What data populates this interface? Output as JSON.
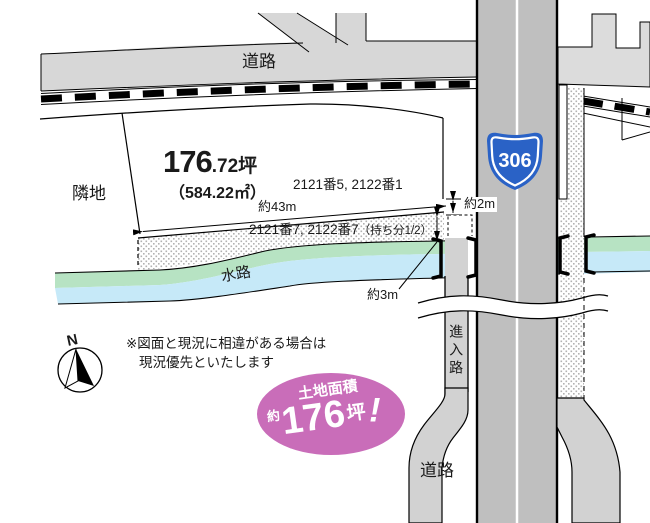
{
  "labels": {
    "road_top": "道路",
    "road_bottom": "道路",
    "neighbor": "隣地",
    "waterway": "水路",
    "approach_road": "進入路",
    "route_number": "306",
    "north": "N"
  },
  "parcel": {
    "area_tsubo_main": "176",
    "area_tsubo_sub": ".72坪",
    "area_m2": "（584.22㎡）",
    "lot_numbers": "2121番5, 2122番1"
  },
  "strip": {
    "lot_numbers": "2121番7, 2122番7",
    "share": "（持ち分1/2）"
  },
  "dimensions": {
    "width": "約43m",
    "gap": "約2m",
    "strip_depth": "約3m"
  },
  "note": {
    "line1": "※図面と現況に相違がある場合は",
    "line2": "現況優先といたします"
  },
  "badge": {
    "title": "土地面積",
    "approx": "約",
    "value": "176",
    "unit": "坪",
    "exclaim": "!"
  },
  "colors": {
    "road_light": "#d7d7d7",
    "road_lighter": "#dcdcdc",
    "road_main": "#bfbfbf",
    "road_approach": "#d2d2d2",
    "water_green": "#b7e3c3",
    "water_blue": "#c6e9f8",
    "route_blue": "#2a62c6",
    "badge_pink": "#c96db9"
  }
}
